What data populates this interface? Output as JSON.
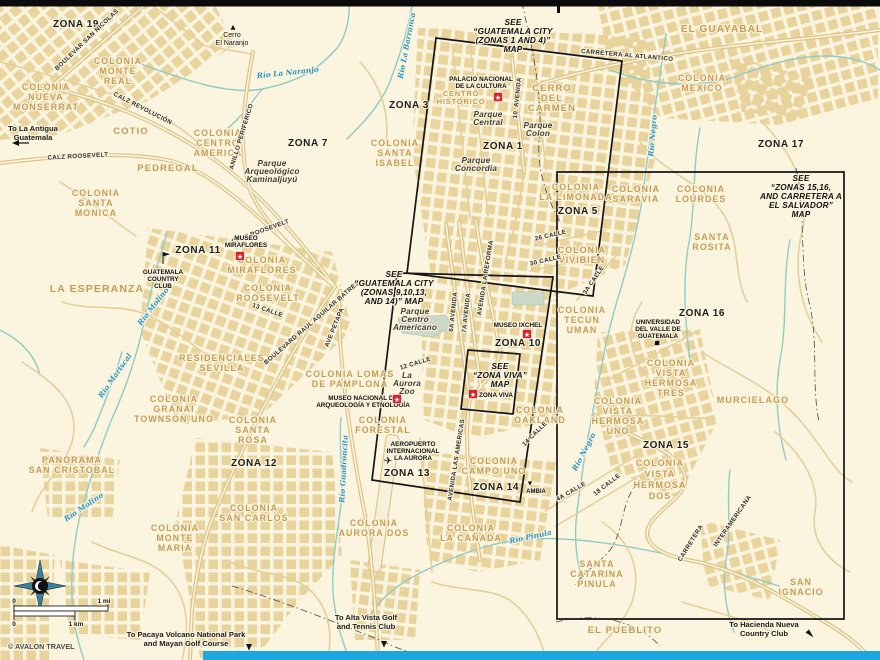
{
  "map": {
    "colors": {
      "background": "#FBF4DE",
      "urban_block": "#E9D29A",
      "road": "#DFC384",
      "road_core": "#FBF7E8",
      "river": "#8FCBC3",
      "water_label": "#2D95C5",
      "colonia_label": "#C69B54",
      "zone_label": "#1d1d1d",
      "inset_box": "#151515",
      "sight_marker": "#D8232A",
      "footer_bar": "#1BA7E0",
      "top_bar": "#0b0b0b",
      "park_fill": "#CCD8C8",
      "credit": "#4a4a4a"
    },
    "credit": "© AVALON TRAVEL",
    "labels": {
      "zones": [
        {
          "t": "ZONA 19",
          "x": 76,
          "y": 27
        },
        {
          "t": "ZONA 3",
          "x": 409,
          "y": 108
        },
        {
          "t": "ZONA 1",
          "x": 503,
          "y": 149
        },
        {
          "t": "ZONA 7",
          "x": 308,
          "y": 146
        },
        {
          "t": "ZONA 17",
          "x": 781,
          "y": 147
        },
        {
          "t": "ZONA 5",
          "x": 578,
          "y": 214
        },
        {
          "t": "ZONA 11",
          "x": 198,
          "y": 253
        },
        {
          "t": "ZONA 16",
          "x": 702,
          "y": 316
        },
        {
          "t": "ZONA 10",
          "x": 518,
          "y": 346
        },
        {
          "t": "ZONA 15",
          "x": 666,
          "y": 448
        },
        {
          "t": "ZONA 12",
          "x": 254,
          "y": 466
        },
        {
          "t": "ZONA 13",
          "x": 407,
          "y": 476
        },
        {
          "t": "ZONA 14",
          "x": 496,
          "y": 490
        }
      ],
      "colonias": [
        {
          "l": [
            "COLONIA",
            "MONTE",
            "REAL"
          ],
          "x": 118,
          "y": 64
        },
        {
          "l": [
            "COLONIA",
            "NUEVA",
            "MONSERRAT"
          ],
          "x": 46,
          "y": 90
        },
        {
          "t": "COTIO",
          "x": 131,
          "y": 134,
          "s": 9.5
        },
        {
          "l": [
            "COLONIA",
            "CENTRO",
            "AMERICA"
          ],
          "x": 218,
          "y": 136
        },
        {
          "t": "PEDREGAL",
          "x": 168,
          "y": 171,
          "s": 9.5
        },
        {
          "l": [
            "COLONIA",
            "SANTA",
            "MONICA"
          ],
          "x": 96,
          "y": 196
        },
        {
          "t": "EL GUAYABAL",
          "x": 722,
          "y": 32,
          "s": 10
        },
        {
          "l": [
            "COLONIA",
            "MEXICO"
          ],
          "x": 702,
          "y": 81
        },
        {
          "l": [
            "COLONIA",
            "SANTA",
            "ISABEL"
          ],
          "x": 395,
          "y": 146
        },
        {
          "l": [
            "CERRO",
            "DEL",
            "CARMEN"
          ],
          "x": 552,
          "y": 91,
          "s": 9.5
        },
        {
          "l": [
            "COLONIA",
            "LA LIMONADA"
          ],
          "x": 576,
          "y": 190
        },
        {
          "l": [
            "COLONIA",
            "SARAVIA"
          ],
          "x": 636,
          "y": 192
        },
        {
          "l": [
            "COLONIA",
            "LOURDES"
          ],
          "x": 701,
          "y": 192
        },
        {
          "l": [
            "SANTA",
            "ROSITA"
          ],
          "x": 712,
          "y": 240
        },
        {
          "l": [
            "COLONIA",
            "VIVIBIEN"
          ],
          "x": 582,
          "y": 253
        },
        {
          "l": [
            "COLONIA",
            "TECUN",
            "UMAN"
          ],
          "x": 582,
          "y": 313
        },
        {
          "l": [
            "COLONIA",
            "MIRAFLORES"
          ],
          "x": 262,
          "y": 263
        },
        {
          "l": [
            "COLONIA",
            "ROOSEVELT"
          ],
          "x": 268,
          "y": 291
        },
        {
          "t": "LA ESPERANZA",
          "x": 97,
          "y": 292,
          "s": 10.5
        },
        {
          "l": [
            "COLONIA LOMAS",
            "DE PAMPLONA"
          ],
          "x": 350,
          "y": 377
        },
        {
          "l": [
            "COLONIA",
            "FORESTAL"
          ],
          "x": 383,
          "y": 423
        },
        {
          "l": [
            "COLONIA",
            "OAKLAND"
          ],
          "x": 540,
          "y": 413
        },
        {
          "l": [
            "COLONIA",
            "CAMPO UNO"
          ],
          "x": 494,
          "y": 464
        },
        {
          "l": [
            "COLONIA",
            "AURORA DOS"
          ],
          "x": 374,
          "y": 526
        },
        {
          "l": [
            "COLONIA",
            "LA CAÑADA"
          ],
          "x": 471,
          "y": 531
        },
        {
          "l": [
            "COLONIA",
            "VISTA",
            "HERMOSA",
            "TRES"
          ],
          "x": 671,
          "y": 366
        },
        {
          "l": [
            "COLONIA",
            "VISTA",
            "HERMOSA",
            "UNO"
          ],
          "x": 618,
          "y": 404
        },
        {
          "l": [
            "COLONIA",
            "VISTA",
            "HERMOSA",
            "DOS"
          ],
          "x": 660,
          "y": 466,
          "lh": 11
        },
        {
          "t": "MURCIELAGO",
          "x": 753,
          "y": 403,
          "s": 9
        },
        {
          "l": [
            "RESIDENCIALES",
            "SEVILLA"
          ],
          "x": 222,
          "y": 361
        },
        {
          "l": [
            "COLONIA",
            "GRANAI",
            "TOWNSON UNO"
          ],
          "x": 174,
          "y": 402
        },
        {
          "l": [
            "COLONIA",
            "SANTA",
            "ROSA"
          ],
          "x": 253,
          "y": 423
        },
        {
          "l": [
            "PANORAMA",
            "SAN CRISTOBAL"
          ],
          "x": 72,
          "y": 463
        },
        {
          "l": [
            "COLONIA",
            "SAN CARLOS"
          ],
          "x": 254,
          "y": 511
        },
        {
          "l": [
            "COLONIA",
            "MONTE",
            "MARIA"
          ],
          "x": 175,
          "y": 531
        },
        {
          "l": [
            "SANTA",
            "CATARINA",
            "PINULA"
          ],
          "x": 597,
          "y": 567
        },
        {
          "l": [
            "SAN",
            "IGNACIO"
          ],
          "x": 801,
          "y": 585
        },
        {
          "t": "EL PUEBLITO",
          "x": 625,
          "y": 633,
          "s": 9.5
        }
      ],
      "parks": [
        {
          "l": [
            "Parque",
            "Arqueológico",
            "Kaminaljuyú"
          ],
          "x": 272,
          "y": 166,
          "lh": 8
        },
        {
          "l": [
            "Parque",
            "Central"
          ],
          "x": 488,
          "y": 117,
          "lh": 8
        },
        {
          "l": [
            "Parque",
            "Colon"
          ],
          "x": 538,
          "y": 128,
          "lh": 8
        },
        {
          "l": [
            "Parque",
            "Concordia"
          ],
          "x": 476,
          "y": 163,
          "lh": 8
        },
        {
          "l": [
            "Parque",
            "Centro",
            "Americano"
          ],
          "x": 415,
          "y": 314,
          "lh": 8
        },
        {
          "l": [
            "La",
            "Aurora",
            "Zoo"
          ],
          "x": 407,
          "y": 378,
          "lh": 8
        }
      ],
      "roads": [
        {
          "t": "BOULEVAR SAN NICOLAS",
          "x": 88,
          "y": 41,
          "r": -44
        },
        {
          "t": "CALZ REVOLUCIÓN",
          "x": 142,
          "y": 110,
          "r": 27
        },
        {
          "t": "CALZ ROOSEVELT",
          "x": 78,
          "y": 158,
          "r": -3
        },
        {
          "t": "CALZ ROOSEVELT",
          "x": 261,
          "y": 233,
          "r": -20
        },
        {
          "t": "ANILLO PERIFERICO",
          "x": 243,
          "y": 137,
          "r": -73
        },
        {
          "t": "BOULEVARD RAUL AGUILAR BATRES",
          "x": 313,
          "y": 324,
          "r": -41
        },
        {
          "t": "AVE PETAPA",
          "x": 336,
          "y": 328,
          "r": -68
        },
        {
          "t": "13 CALLE",
          "x": 267,
          "y": 312,
          "r": 19
        },
        {
          "t": "12 CALLE",
          "x": 416,
          "y": 365,
          "r": -17
        },
        {
          "t": "10. AVENIDA",
          "x": 519,
          "y": 98,
          "r": -84
        },
        {
          "t": "6A AVENIDA",
          "x": 455,
          "y": 312,
          "r": -84
        },
        {
          "t": "7A AVENIDA",
          "x": 468,
          "y": 313,
          "r": -84
        },
        {
          "t": "AVENIDA LA REFORMA",
          "x": 487,
          "y": 278,
          "r": -81
        },
        {
          "t": "AVENIDA LAS AMERICAS",
          "x": 458,
          "y": 460,
          "r": -81
        },
        {
          "t": "26 CALLE",
          "x": 551,
          "y": 237,
          "r": -13
        },
        {
          "t": "30 CALLE",
          "x": 546,
          "y": 262,
          "r": -13
        },
        {
          "t": "3A CALLE",
          "x": 595,
          "y": 281,
          "r": -56
        },
        {
          "t": "CARRETERA AL ATLANTICO",
          "x": 627,
          "y": 57,
          "r": 5
        },
        {
          "t": "INTERAMERICANA",
          "x": 734,
          "y": 522,
          "r": -55
        },
        {
          "t": "CARRETERA",
          "x": 692,
          "y": 544,
          "r": -58
        },
        {
          "t": "18 CALLE",
          "x": 608,
          "y": 486,
          "r": -38
        },
        {
          "t": "4A CALLE",
          "x": 572,
          "y": 493,
          "r": -30
        },
        {
          "t": "14 CALLE",
          "x": 536,
          "y": 435,
          "r": -45
        }
      ],
      "rivers": [
        {
          "t": "Río La Naranjo",
          "x": 288,
          "y": 75,
          "r": -6
        },
        {
          "t": "Río La Barranca",
          "x": 409,
          "y": 46,
          "r": -79
        },
        {
          "t": "Río Negro",
          "x": 655,
          "y": 136,
          "r": -85
        },
        {
          "t": "Río Negro",
          "x": 586,
          "y": 453,
          "r": -62
        },
        {
          "t": "Río Molino",
          "x": 155,
          "y": 308,
          "r": -52
        },
        {
          "t": "Río Molino",
          "x": 85,
          "y": 509,
          "r": -34
        },
        {
          "t": "Río Mariscal",
          "x": 117,
          "y": 377,
          "r": -55
        },
        {
          "t": "Río Guadroncita",
          "x": 346,
          "y": 469,
          "r": -87
        },
        {
          "t": "Río Pinula",
          "x": 531,
          "y": 539,
          "r": -12
        }
      ],
      "pois": [
        {
          "l": [
            "PALACIO NACIONAL",
            "DE LA CULTURA"
          ],
          "x": 481,
          "y": 81,
          "lh": 7
        },
        {
          "l": [
            "CENTRO",
            "HISTORICO"
          ],
          "x": 461,
          "y": 96,
          "lh": 8,
          "cls": "poi-orange",
          "s": 7.5
        },
        {
          "l": [
            "MUSEO",
            "MIRAFLORES"
          ],
          "x": 246,
          "y": 240,
          "lh": 7
        },
        {
          "t": "MUSEO IXCHEL",
          "x": 518,
          "y": 327
        },
        {
          "t": "ZONA VIVA",
          "x": 496,
          "y": 397
        },
        {
          "l": [
            "MUSEO NACIONAL DE",
            "ARQUEOLOGÍA Y ETNOLOGÍA"
          ],
          "x": 363,
          "y": 400,
          "lh": 7
        },
        {
          "l": [
            "AEROPUERTO",
            "INTERNACIONAL",
            "LA AURORA"
          ],
          "x": 413,
          "y": 446,
          "lh": 7
        },
        {
          "l": [
            "GUATEMALA",
            "COUNTRY",
            "CLUB"
          ],
          "x": 163,
          "y": 274,
          "lh": 7
        },
        {
          "l": [
            "UNIVERSIDAD",
            "DEL VALLE DE",
            "GUATEMALA"
          ],
          "x": 658,
          "y": 324,
          "lh": 7
        },
        {
          "l": [
            "Cerro",
            "El Naranjo"
          ],
          "x": 232,
          "y": 37,
          "lh": 8,
          "cls": "poi-plain",
          "s": 7
        },
        {
          "t": "AMBIA",
          "x": 536,
          "y": 493,
          "s": 6
        }
      ],
      "notes": [
        {
          "l": [
            "To La Antigua",
            "Guatemala"
          ],
          "x": 33,
          "y": 131,
          "lh": 9
        },
        {
          "l": [
            "To Pacaya Volcano National Park",
            "and Mayan Golf Course"
          ],
          "x": 186,
          "y": 637,
          "lh": 9
        },
        {
          "l": [
            "To Alta Vista Golf",
            "and Tennis Club"
          ],
          "x": 366,
          "y": 620,
          "lh": 9
        },
        {
          "l": [
            "To Hacienda Nueva",
            "Country Club"
          ],
          "x": 764,
          "y": 627,
          "lh": 9
        },
        {
          "t": "0",
          "x": 14,
          "y": 603,
          "s": 6.5
        },
        {
          "t": "1 mi",
          "x": 104,
          "y": 603,
          "s": 6.5
        },
        {
          "t": "0",
          "x": 14,
          "y": 626,
          "s": 6.5
        },
        {
          "t": "1 km",
          "x": 76,
          "y": 626,
          "s": 6.5
        },
        {
          "t": "© AVALON TRAVEL",
          "x": 8,
          "y": 649,
          "a": "start",
          "s": 7.2,
          "c": "#4a4a4a"
        }
      ],
      "see_maps": [
        {
          "l": [
            "SEE",
            "“GUATEMALA CITY",
            "(ZONAS 1 AND 4)”",
            "MAP"
          ],
          "x": 513,
          "y": 25,
          "lh": 9
        },
        {
          "l": [
            "SEE",
            "“GUATEMALA CITY",
            "(ZONAS 9,10,13,",
            "AND 14)” MAP"
          ],
          "x": 394,
          "y": 277,
          "lh": 9
        },
        {
          "l": [
            "SEE",
            "“ZONA VIVA”",
            "MAP"
          ],
          "x": 500,
          "y": 369,
          "lh": 9
        },
        {
          "l": [
            "SEE",
            "“ZONAS 15,16,",
            "AND CARRETERA A",
            "EL SALVADOR”",
            "MAP"
          ],
          "x": 801,
          "y": 181,
          "lh": 9
        }
      ]
    },
    "icons": [
      {
        "k": "sight",
        "x": 498,
        "y": 97
      },
      {
        "k": "sight",
        "x": 240,
        "y": 256
      },
      {
        "k": "sight",
        "x": 527,
        "y": 334
      },
      {
        "k": "sight",
        "x": 473,
        "y": 394
      },
      {
        "k": "sight",
        "x": 397,
        "y": 399
      },
      {
        "k": "plane",
        "x": 388,
        "y": 464
      },
      {
        "k": "flag",
        "x": 163,
        "y": 258
      },
      {
        "k": "square",
        "x": 657,
        "y": 343
      },
      {
        "k": "peak",
        "x": 233,
        "y": 29
      },
      {
        "k": "tri-down",
        "x": 530,
        "y": 485
      },
      {
        "k": "arrow-left",
        "x": 12,
        "y": 143
      },
      {
        "k": "arrow-down",
        "x": 249,
        "y": 644
      },
      {
        "k": "arrow-down",
        "x": 384,
        "y": 641
      },
      {
        "k": "arrow-se",
        "x": 810,
        "y": 634
      }
    ]
  }
}
